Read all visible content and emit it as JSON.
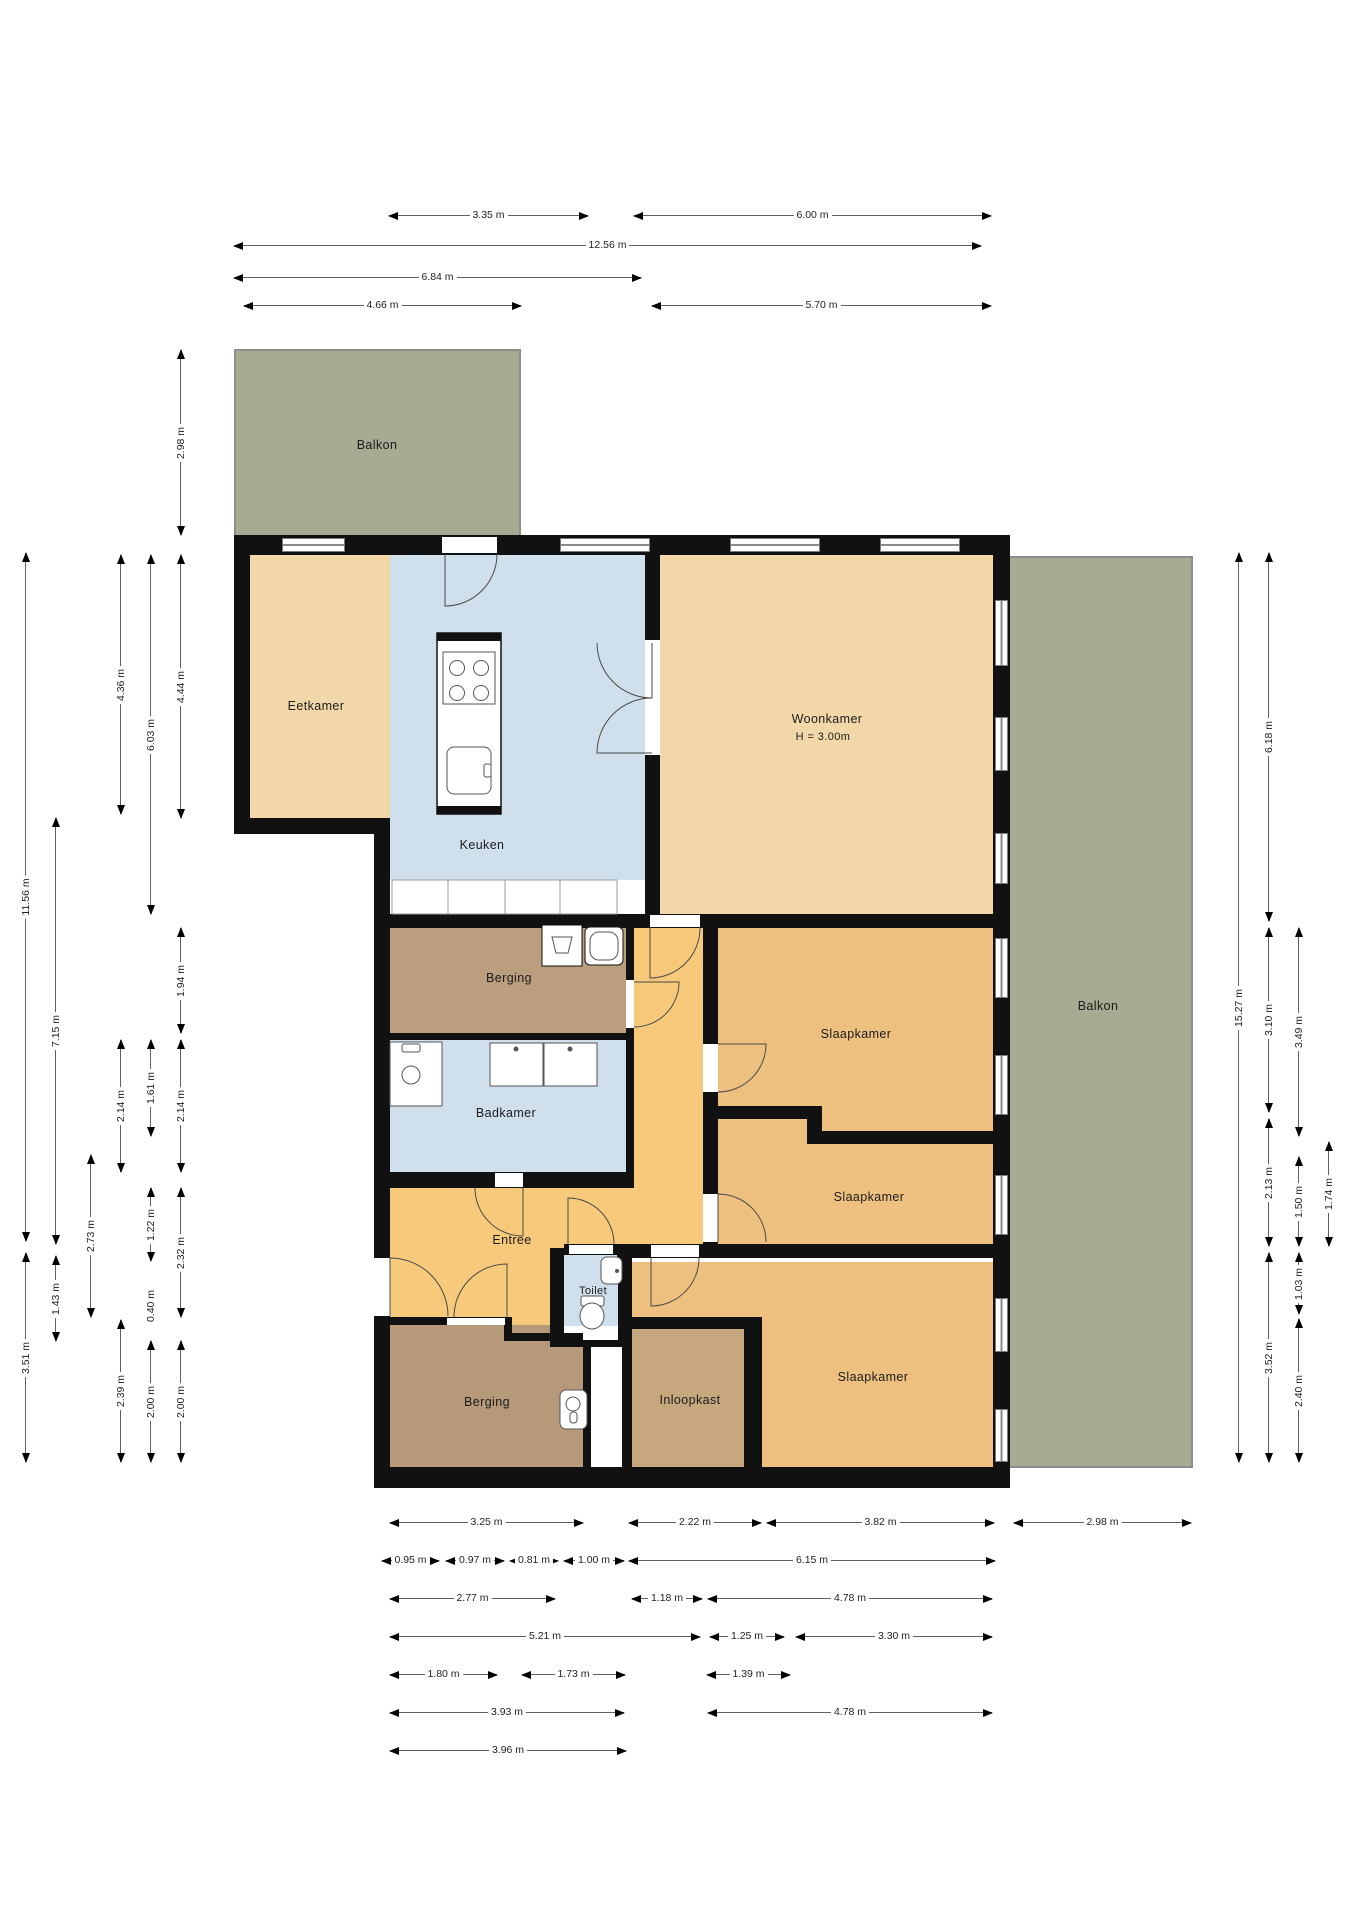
{
  "canvas": {
    "width": 1358,
    "height": 1920,
    "background": "#ffffff"
  },
  "colors": {
    "wall": "#111111",
    "stroke": "#555555",
    "dim_line": "#606060",
    "dim_text": "#222222",
    "tan_light": "#f2d8a8",
    "tan_mid": "#edc07f",
    "orange": "#f7c97b",
    "blue": "#cfdfec",
    "brown": "#bb9e7e",
    "brown_dark": "#b69978",
    "brown_light": "#c7a77d",
    "green": "#a6ab92",
    "white": "#ffffff"
  },
  "rooms": [
    {
      "name": "balkon-top",
      "x": 234,
      "y": 349,
      "w": 287,
      "h": 186,
      "c": "green",
      "rail": "t"
    },
    {
      "name": "eetkamer",
      "x": 250,
      "y": 555,
      "w": 140,
      "h": 263,
      "c": "tan_light"
    },
    {
      "name": "keuken",
      "x": 390,
      "y": 555,
      "w": 255,
      "h": 325,
      "c": "blue"
    },
    {
      "name": "woonkamer",
      "x": 660,
      "y": 555,
      "w": 333,
      "h": 359,
      "c": "tan_light"
    },
    {
      "name": "slaapkamer-1-2",
      "x": 718,
      "y": 928,
      "w": 275,
      "h": 316,
      "c": "tan_mid"
    },
    {
      "name": "hal",
      "x": 634,
      "y": 928,
      "w": 69,
      "h": 320,
      "c": "orange"
    },
    {
      "name": "berging-top",
      "x": 390,
      "y": 928,
      "w": 236,
      "h": 105,
      "c": "brown"
    },
    {
      "name": "badkamer",
      "x": 390,
      "y": 1040,
      "w": 236,
      "h": 132,
      "c": "blue"
    },
    {
      "name": "entree-main",
      "x": 390,
      "y": 1188,
      "w": 313,
      "h": 60,
      "c": "orange"
    },
    {
      "name": "entree-lower",
      "x": 390,
      "y": 1248,
      "w": 160,
      "h": 92,
      "c": "orange"
    },
    {
      "name": "berging-bottom",
      "x": 390,
      "y": 1325,
      "w": 193,
      "h": 142,
      "c": "brown_dark"
    },
    {
      "name": "toilet",
      "x": 564,
      "y": 1255,
      "w": 54,
      "h": 71,
      "c": "blue"
    },
    {
      "name": "toilet-sill",
      "x": 564,
      "y": 1326,
      "w": 54,
      "h": 14,
      "c": "white"
    },
    {
      "name": "slaapkamer-3",
      "x": 632,
      "y": 1262,
      "w": 361,
      "h": 205,
      "c": "tan_mid"
    },
    {
      "name": "inloopkast",
      "x": 632,
      "y": 1329,
      "w": 112,
      "h": 138,
      "c": "brown_light"
    },
    {
      "name": "balkon-right",
      "x": 1010,
      "y": 556,
      "w": 183,
      "h": 912,
      "c": "green",
      "rail": "r"
    }
  ],
  "walls": [
    {
      "x": 234,
      "y": 535,
      "w": 776,
      "h": 20
    },
    {
      "x": 234,
      "y": 535,
      "w": 16,
      "h": 299
    },
    {
      "x": 234,
      "y": 818,
      "w": 156,
      "h": 16
    },
    {
      "x": 374,
      "y": 818,
      "w": 16,
      "h": 670
    },
    {
      "x": 374,
      "y": 1467,
      "w": 636,
      "h": 21
    },
    {
      "x": 993,
      "y": 535,
      "w": 17,
      "h": 953
    },
    {
      "x": 645,
      "y": 555,
      "w": 15,
      "h": 359
    },
    {
      "x": 374,
      "y": 914,
      "w": 636,
      "h": 14
    },
    {
      "x": 626,
      "y": 928,
      "w": 8,
      "h": 260
    },
    {
      "x": 390,
      "y": 1033,
      "w": 236,
      "h": 7
    },
    {
      "x": 390,
      "y": 1172,
      "w": 236,
      "h": 16
    },
    {
      "x": 703,
      "y": 928,
      "w": 15,
      "h": 316
    },
    {
      "x": 703,
      "y": 1106,
      "w": 104,
      "h": 13
    },
    {
      "x": 807,
      "y": 1106,
      "w": 15,
      "h": 38
    },
    {
      "x": 822,
      "y": 1131,
      "w": 171,
      "h": 13
    },
    {
      "x": 617,
      "y": 1244,
      "w": 393,
      "h": 14
    },
    {
      "x": 550,
      "y": 1248,
      "w": 14,
      "h": 99
    },
    {
      "x": 618,
      "y": 1255,
      "w": 14,
      "h": 92
    },
    {
      "x": 564,
      "y": 1244,
      "w": 54,
      "h": 11
    },
    {
      "x": 550,
      "y": 1340,
      "w": 82,
      "h": 7
    },
    {
      "x": 583,
      "y": 1341,
      "w": 8,
      "h": 126
    },
    {
      "x": 622,
      "y": 1341,
      "w": 10,
      "h": 126
    },
    {
      "x": 374,
      "y": 1317,
      "w": 138,
      "h": 8
    },
    {
      "x": 504,
      "y": 1333,
      "w": 79,
      "h": 8
    },
    {
      "x": 504,
      "y": 1317,
      "w": 8,
      "h": 24
    },
    {
      "x": 628,
      "y": 1317,
      "w": 116,
      "h": 12
    },
    {
      "x": 744,
      "y": 1317,
      "w": 18,
      "h": 150
    }
  ],
  "openings": [
    {
      "x": 442,
      "y": 537,
      "w": 55,
      "h": 16
    },
    {
      "x": 645,
      "y": 640,
      "w": 15,
      "h": 115
    },
    {
      "x": 650,
      "y": 915,
      "w": 50,
      "h": 12
    },
    {
      "x": 626,
      "y": 980,
      "w": 8,
      "h": 48
    },
    {
      "x": 703,
      "y": 1044,
      "w": 15,
      "h": 48
    },
    {
      "x": 703,
      "y": 1194,
      "w": 15,
      "h": 48
    },
    {
      "x": 495,
      "y": 1173,
      "w": 28,
      "h": 14
    },
    {
      "x": 569,
      "y": 1245,
      "w": 44,
      "h": 9
    },
    {
      "x": 651,
      "y": 1245,
      "w": 48,
      "h": 12
    },
    {
      "x": 447,
      "y": 1318,
      "w": 58,
      "h": 7
    },
    {
      "x": 374,
      "y": 1258,
      "w": 16,
      "h": 58
    }
  ],
  "windows": [
    {
      "x": 282,
      "y": 538,
      "w": 63,
      "h": 14,
      "o": "h"
    },
    {
      "x": 560,
      "y": 538,
      "w": 90,
      "h": 14,
      "o": "h"
    },
    {
      "x": 730,
      "y": 538,
      "w": 90,
      "h": 14,
      "o": "h"
    },
    {
      "x": 880,
      "y": 538,
      "w": 80,
      "h": 14,
      "o": "h"
    },
    {
      "x": 995,
      "y": 600,
      "w": 13,
      "h": 66,
      "o": "v"
    },
    {
      "x": 995,
      "y": 717,
      "w": 13,
      "h": 54,
      "o": "v"
    },
    {
      "x": 995,
      "y": 833,
      "w": 13,
      "h": 51,
      "o": "v"
    },
    {
      "x": 995,
      "y": 938,
      "w": 13,
      "h": 60,
      "o": "v"
    },
    {
      "x": 995,
      "y": 1055,
      "w": 13,
      "h": 60,
      "o": "v"
    },
    {
      "x": 995,
      "y": 1175,
      "w": 13,
      "h": 60,
      "o": "v"
    },
    {
      "x": 995,
      "y": 1298,
      "w": 13,
      "h": 54,
      "o": "v"
    },
    {
      "x": 995,
      "y": 1409,
      "w": 13,
      "h": 53,
      "o": "v"
    }
  ],
  "doors": [
    {
      "px": 445,
      "py": 554,
      "r": 52,
      "a1": 90,
      "a2": 0,
      "sw": 0
    },
    {
      "px": 652,
      "py": 643,
      "r": 55,
      "a1": 90,
      "a2": 180,
      "sw": 1
    },
    {
      "px": 652,
      "py": 753,
      "r": 55,
      "a1": 180,
      "a2": 270,
      "sw": 1
    },
    {
      "px": 650,
      "py": 928,
      "r": 50,
      "a1": 90,
      "a2": 0,
      "sw": 0
    },
    {
      "px": 634,
      "py": 982,
      "r": 45,
      "a1": 0,
      "a2": 90,
      "sw": 1
    },
    {
      "px": 718,
      "py": 1044,
      "r": 48,
      "a1": 0,
      "a2": 90,
      "sw": 1
    },
    {
      "px": 718,
      "py": 1242,
      "r": 48,
      "a1": 270,
      "a2": 0,
      "sw": 1
    },
    {
      "px": 523,
      "py": 1188,
      "r": 48,
      "a1": 90,
      "a2": 180,
      "sw": 1
    },
    {
      "px": 568,
      "py": 1244,
      "r": 46,
      "a1": 270,
      "a2": 0,
      "sw": 1
    },
    {
      "px": 651,
      "py": 1258,
      "r": 48,
      "a1": 90,
      "a2": 0,
      "sw": 0
    },
    {
      "px": 507,
      "py": 1317,
      "r": 53,
      "a1": 270,
      "a2": 180,
      "sw": 0
    },
    {
      "px": 390,
      "py": 1316,
      "r": 58,
      "a1": 270,
      "a2": 0,
      "sw": 1
    }
  ],
  "fixtures": [
    {
      "t": "r",
      "n": "kitchen-counter",
      "x": 392,
      "y": 880,
      "w": 56,
      "h": 34,
      "f": "#ffffff",
      "s": "#999999"
    },
    {
      "t": "r",
      "n": "kitchen-counter",
      "x": 448,
      "y": 880,
      "w": 57,
      "h": 34,
      "f": "#ffffff",
      "s": "#999999"
    },
    {
      "t": "r",
      "n": "kitchen-counter",
      "x": 505,
      "y": 880,
      "w": 55,
      "h": 34,
      "f": "#ffffff",
      "s": "#999999"
    },
    {
      "t": "r",
      "n": "kitchen-counter",
      "x": 560,
      "y": 880,
      "w": 57,
      "h": 34,
      "f": "#ffffff",
      "s": "#999999"
    },
    {
      "t": "r",
      "n": "kitchen-island",
      "x": 437,
      "y": 633,
      "w": 64,
      "h": 181,
      "f": "#ffffff",
      "s": "#111111",
      "sw": 1.5
    },
    {
      "t": "r",
      "n": "island-edge",
      "x": 437,
      "y": 633,
      "w": 64,
      "h": 8,
      "f": "#111111"
    },
    {
      "t": "r",
      "n": "island-edge",
      "x": 437,
      "y": 806,
      "w": 64,
      "h": 8,
      "f": "#111111"
    },
    {
      "t": "r",
      "n": "cooktop",
      "x": 443,
      "y": 652,
      "w": 52,
      "h": 52,
      "f": "#ffffff",
      "s": "#555555"
    },
    {
      "t": "c",
      "n": "burner",
      "cx": 457,
      "cy": 668,
      "r": 7.5,
      "s": "#555555"
    },
    {
      "t": "c",
      "n": "burner",
      "cx": 481,
      "cy": 668,
      "r": 7.5,
      "s": "#555555"
    },
    {
      "t": "c",
      "n": "burner",
      "cx": 457,
      "cy": 693,
      "r": 7.5,
      "s": "#555555"
    },
    {
      "t": "c",
      "n": "burner",
      "cx": 481,
      "cy": 693,
      "r": 7.5,
      "s": "#555555"
    },
    {
      "t": "r",
      "n": "island-sink",
      "x": 447,
      "y": 747,
      "w": 44,
      "h": 47,
      "rx": 7,
      "f": "#ffffff",
      "s": "#555555"
    },
    {
      "t": "r",
      "n": "island-faucet",
      "x": 484,
      "y": 764,
      "w": 7,
      "h": 13,
      "rx": 2,
      "f": "#ffffff",
      "s": "#555555"
    },
    {
      "t": "r",
      "n": "washer",
      "x": 542,
      "y": 925,
      "w": 40,
      "h": 41,
      "f": "#ffffff",
      "s": "#111111"
    },
    {
      "t": "p",
      "n": "washer-tub",
      "d": "M552,937 L572,937 L568,953 L556,953 Z",
      "s": "#555555"
    },
    {
      "t": "r",
      "n": "dryer",
      "x": 585,
      "y": 927,
      "w": 38,
      "h": 38,
      "rx": 5,
      "f": "#ffffff",
      "s": "#111111"
    },
    {
      "t": "r",
      "n": "dryer-drum",
      "x": 590,
      "y": 932,
      "w": 28,
      "h": 28,
      "rx": 9,
      "f": "#ffffff",
      "s": "#555555"
    },
    {
      "t": "r",
      "n": "shower-tray",
      "x": 390,
      "y": 1042,
      "w": 52,
      "h": 64,
      "f": "#ffffff",
      "s": "#555555"
    },
    {
      "t": "r",
      "n": "shower-tap",
      "x": 402,
      "y": 1044,
      "w": 18,
      "h": 8,
      "rx": 2,
      "f": "#ffffff",
      "s": "#555555"
    },
    {
      "t": "c",
      "n": "shower-drain",
      "cx": 411,
      "cy": 1075,
      "r": 9,
      "s": "#555555"
    },
    {
      "t": "r",
      "n": "basin",
      "x": 490,
      "y": 1043,
      "w": 53,
      "h": 43,
      "f": "#ffffff",
      "s": "#555555"
    },
    {
      "t": "c",
      "n": "basin-tap",
      "cx": 516,
      "cy": 1049,
      "r": 2.5,
      "f": "#555555"
    },
    {
      "t": "r",
      "n": "basin",
      "x": 544,
      "y": 1043,
      "w": 53,
      "h": 43,
      "f": "#ffffff",
      "s": "#555555"
    },
    {
      "t": "c",
      "n": "basin-tap",
      "cx": 570,
      "cy": 1049,
      "r": 2.5,
      "f": "#555555"
    },
    {
      "t": "r",
      "n": "wc-cistern",
      "x": 581,
      "y": 1296,
      "w": 23,
      "h": 10,
      "rx": 2,
      "f": "#ffffff",
      "s": "#555555"
    },
    {
      "t": "e",
      "n": "wc-bowl",
      "cx": 592,
      "cy": 1316,
      "rx": 12,
      "ry": 13,
      "f": "#ffffff",
      "s": "#555555"
    },
    {
      "t": "r",
      "n": "hand-basin",
      "x": 601,
      "y": 1257,
      "w": 21,
      "h": 27,
      "rx": 6,
      "f": "#ffffff",
      "s": "#555555"
    },
    {
      "t": "c",
      "n": "hand-basin-tap",
      "cx": 617,
      "cy": 1271,
      "r": 2,
      "f": "#555555"
    },
    {
      "t": "r",
      "n": "boiler",
      "x": 560,
      "y": 1390,
      "w": 27,
      "h": 39,
      "rx": 6,
      "f": "#ffffff",
      "s": "#555555"
    },
    {
      "t": "c",
      "n": "boiler-dial",
      "cx": 573,
      "cy": 1404,
      "r": 7,
      "s": "#555555"
    },
    {
      "t": "r",
      "n": "boiler-slot",
      "x": 570,
      "y": 1412,
      "w": 7,
      "h": 11,
      "rx": 3,
      "f": "#ffffff",
      "s": "#555555"
    }
  ],
  "labels": [
    {
      "text": "Balkon",
      "x": 377,
      "y": 445
    },
    {
      "text": "Eetkamer",
      "x": 316,
      "y": 706
    },
    {
      "text": "Keuken",
      "x": 482,
      "y": 845
    },
    {
      "text": "Woonkamer",
      "x": 827,
      "y": 719
    },
    {
      "text": "H = 3.00m",
      "x": 823,
      "y": 737,
      "size": 11
    },
    {
      "text": "Slaapkamer",
      "x": 856,
      "y": 1034
    },
    {
      "text": "Slaapkamer",
      "x": 869,
      "y": 1197
    },
    {
      "text": "Slaapkamer",
      "x": 873,
      "y": 1377
    },
    {
      "text": "Berging",
      "x": 509,
      "y": 978
    },
    {
      "text": "Badkamer",
      "x": 506,
      "y": 1113
    },
    {
      "text": "Entree",
      "x": 512,
      "y": 1240
    },
    {
      "text": "Toilet",
      "x": 593,
      "y": 1291,
      "size": 11
    },
    {
      "text": "Berging",
      "x": 487,
      "y": 1402
    },
    {
      "text": "Inloopkast",
      "x": 690,
      "y": 1400
    },
    {
      "text": "Balkon",
      "x": 1098,
      "y": 1006
    }
  ],
  "dims": [
    {
      "text": "3.35 m",
      "o": "h",
      "x": 389,
      "y": 215,
      "len": 199
    },
    {
      "text": "6.00 m",
      "o": "h",
      "x": 634,
      "y": 215,
      "len": 357
    },
    {
      "text": "12.56 m",
      "o": "h",
      "x": 234,
      "y": 245,
      "len": 747
    },
    {
      "text": "6.84 m",
      "o": "h",
      "x": 234,
      "y": 277,
      "len": 407
    },
    {
      "text": "4.66 m",
      "o": "h",
      "x": 244,
      "y": 305,
      "len": 277
    },
    {
      "text": "5.70 m",
      "o": "h",
      "x": 652,
      "y": 305,
      "len": 339
    },
    {
      "text": "3.25 m",
      "o": "h",
      "x": 390,
      "y": 1522,
      "len": 193
    },
    {
      "text": "2.22 m",
      "o": "h",
      "x": 629,
      "y": 1522,
      "len": 132
    },
    {
      "text": "3.82 m",
      "o": "h",
      "x": 767,
      "y": 1522,
      "len": 227
    },
    {
      "text": "2.98 m",
      "o": "h",
      "x": 1014,
      "y": 1522,
      "len": 177
    },
    {
      "text": "0.95 m",
      "o": "h",
      "x": 382,
      "y": 1560,
      "len": 57
    },
    {
      "text": "0.97 m",
      "o": "h",
      "x": 446,
      "y": 1560,
      "len": 58
    },
    {
      "text": "0.81 m",
      "o": "h",
      "x": 510,
      "y": 1560,
      "len": 48
    },
    {
      "text": "1.00 m",
      "o": "h",
      "x": 564,
      "y": 1560,
      "len": 60
    },
    {
      "text": "6.15 m",
      "o": "h",
      "x": 629,
      "y": 1560,
      "len": 366
    },
    {
      "text": "2.77 m",
      "o": "h",
      "x": 390,
      "y": 1598,
      "len": 165
    },
    {
      "text": "1.18 m",
      "o": "h",
      "x": 632,
      "y": 1598,
      "len": 70
    },
    {
      "text": "4.78 m",
      "o": "h",
      "x": 708,
      "y": 1598,
      "len": 284
    },
    {
      "text": "5.21 m",
      "o": "h",
      "x": 390,
      "y": 1636,
      "len": 310
    },
    {
      "text": "1.25 m",
      "o": "h",
      "x": 710,
      "y": 1636,
      "len": 74
    },
    {
      "text": "3.30 m",
      "o": "h",
      "x": 796,
      "y": 1636,
      "len": 196
    },
    {
      "text": "1.80 m",
      "o": "h",
      "x": 390,
      "y": 1674,
      "len": 107
    },
    {
      "text": "1.73 m",
      "o": "h",
      "x": 522,
      "y": 1674,
      "len": 103
    },
    {
      "text": "1.39 m",
      "o": "h",
      "x": 707,
      "y": 1674,
      "len": 83
    },
    {
      "text": "3.93 m",
      "o": "h",
      "x": 390,
      "y": 1712,
      "len": 234
    },
    {
      "text": "4.78 m",
      "o": "h",
      "x": 708,
      "y": 1712,
      "len": 284
    },
    {
      "text": "3.96 m",
      "o": "h",
      "x": 390,
      "y": 1750,
      "len": 236
    },
    {
      "text": "2.98 m",
      "o": "v",
      "x": 180,
      "y": 350,
      "len": 185
    },
    {
      "text": "4.36 m",
      "o": "v",
      "x": 120,
      "y": 555,
      "len": 259
    },
    {
      "text": "4.44 m",
      "o": "v",
      "x": 180,
      "y": 555,
      "len": 263
    },
    {
      "text": "6.03 m",
      "o": "v",
      "x": 150,
      "y": 555,
      "len": 359
    },
    {
      "text": "11.56 m",
      "o": "v",
      "x": 25,
      "y": 553,
      "len": 688
    },
    {
      "text": "7.15 m",
      "o": "v",
      "x": 55,
      "y": 818,
      "len": 426
    },
    {
      "text": "1.94 m",
      "o": "v",
      "x": 180,
      "y": 928,
      "len": 105
    },
    {
      "text": "2.14 m",
      "o": "v",
      "x": 180,
      "y": 1040,
      "len": 132
    },
    {
      "text": "2.32 m",
      "o": "v",
      "x": 180,
      "y": 1188,
      "len": 129
    },
    {
      "text": "2.00 m",
      "o": "v",
      "x": 180,
      "y": 1341,
      "len": 121
    },
    {
      "text": "1.61 m",
      "o": "v",
      "x": 150,
      "y": 1040,
      "len": 96
    },
    {
      "text": "1.22 m",
      "o": "v",
      "x": 150,
      "y": 1188,
      "len": 73
    },
    {
      "text": "0.40 m",
      "o": "v",
      "x": 150,
      "y": 1294,
      "len": 24
    },
    {
      "text": "2.00 m",
      "o": "v",
      "x": 150,
      "y": 1341,
      "len": 121
    },
    {
      "text": "2.14 m",
      "o": "v",
      "x": 120,
      "y": 1040,
      "len": 132
    },
    {
      "text": "2.39 m",
      "o": "v",
      "x": 120,
      "y": 1320,
      "len": 142
    },
    {
      "text": "2.73 m",
      "o": "v",
      "x": 90,
      "y": 1155,
      "len": 162
    },
    {
      "text": "1.43 m",
      "o": "v",
      "x": 55,
      "y": 1256,
      "len": 85
    },
    {
      "text": "3.51 m",
      "o": "v",
      "x": 25,
      "y": 1253,
      "len": 209
    },
    {
      "text": "15.27 m",
      "o": "v",
      "x": 1238,
      "y": 553,
      "len": 909
    },
    {
      "text": "6.18 m",
      "o": "v",
      "x": 1268,
      "y": 553,
      "len": 368
    },
    {
      "text": "3.10 m",
      "o": "v",
      "x": 1268,
      "y": 928,
      "len": 184
    },
    {
      "text": "2.13 m",
      "o": "v",
      "x": 1268,
      "y": 1119,
      "len": 127
    },
    {
      "text": "3.52 m",
      "o": "v",
      "x": 1268,
      "y": 1253,
      "len": 209
    },
    {
      "text": "3.49 m",
      "o": "v",
      "x": 1298,
      "y": 928,
      "len": 208
    },
    {
      "text": "1.50 m",
      "o": "v",
      "x": 1298,
      "y": 1157,
      "len": 89
    },
    {
      "text": "1.03 m",
      "o": "v",
      "x": 1298,
      "y": 1253,
      "len": 61
    },
    {
      "text": "2.40 m",
      "o": "v",
      "x": 1298,
      "y": 1319,
      "len": 143
    },
    {
      "text": "1.74 m",
      "o": "v",
      "x": 1328,
      "y": 1142,
      "len": 104
    }
  ]
}
